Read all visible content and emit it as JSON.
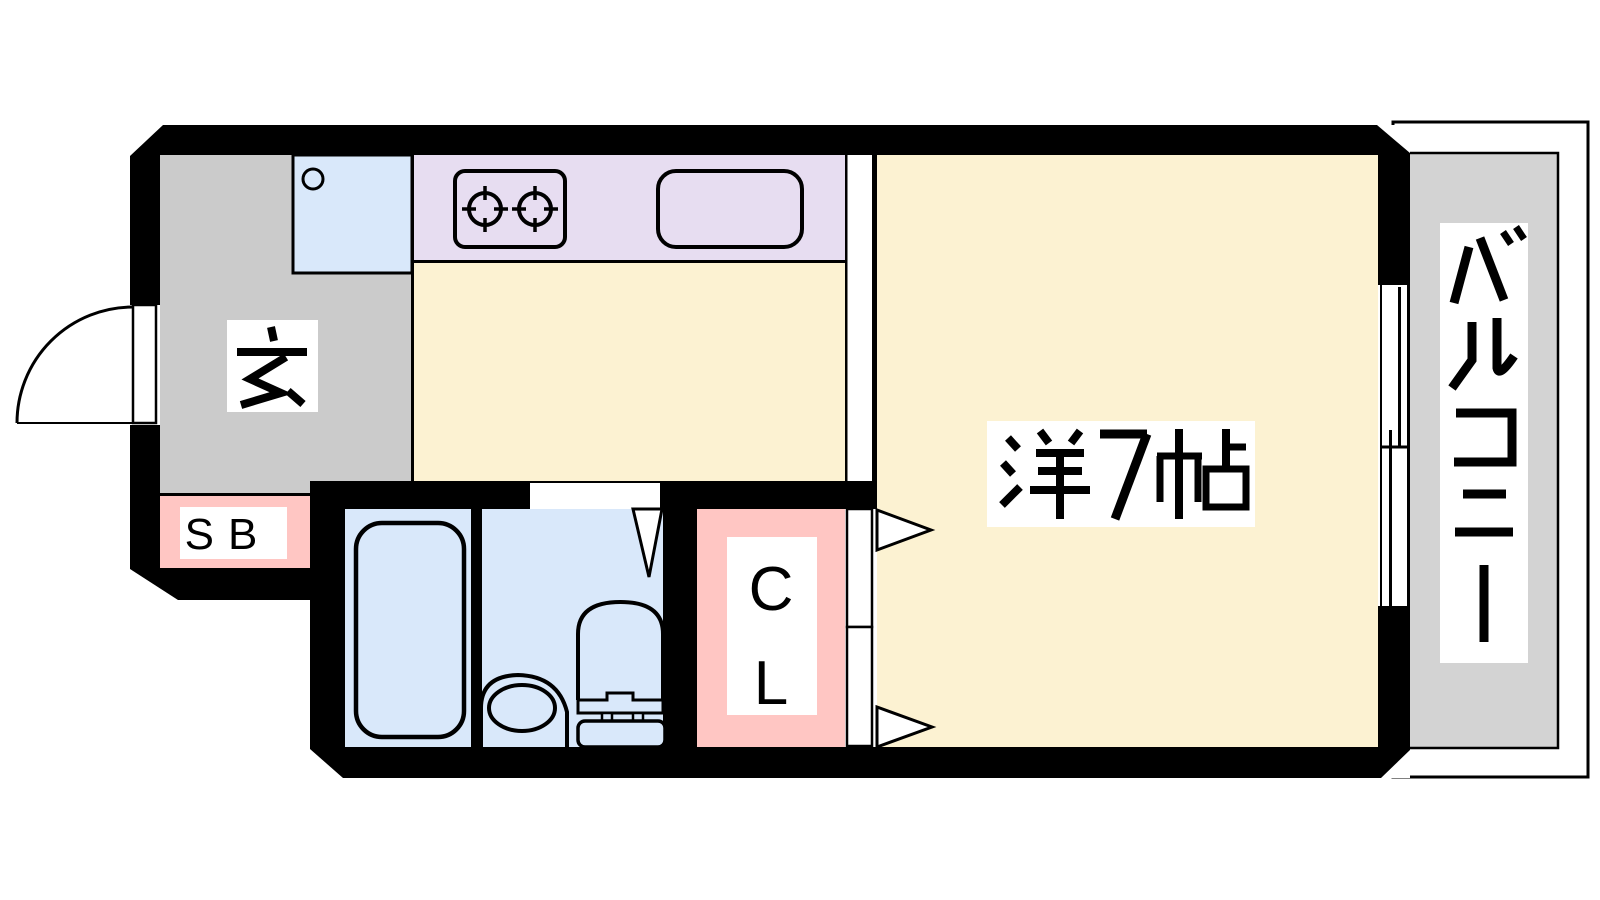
{
  "palette": {
    "bg": "#ffffff",
    "wall": "#000000",
    "line": "#000000",
    "floor": "#fcf2d2",
    "counter": "#e7ddf1",
    "water": "#d9e8fa",
    "entrance": "#cbcbcb",
    "balcony": "#d3d3d3",
    "pink": "#ffc6c3",
    "label-bg": "#ffffff"
  },
  "rooms": {
    "entrance": {
      "label": "玄"
    },
    "main_room": {
      "label": "洋7帖"
    },
    "balcony": {
      "label": "バルコニー"
    },
    "shoe_box": {
      "label": "SB"
    },
    "closet": {
      "label": "CL",
      "chars": [
        "C",
        "L"
      ]
    }
  },
  "fixtures": {
    "entrance_door": "swing-door",
    "washing_pan": "washing-machine-pan",
    "stove": "two-burner-stove",
    "kitchen_sink": "kitchen-sink",
    "bathtub": "bathtub",
    "washbasin": "washbasin",
    "toilet": "toilet",
    "window": "sliding-window",
    "closet_doors": "folding-doors",
    "bathroom_door": "swing-door"
  }
}
